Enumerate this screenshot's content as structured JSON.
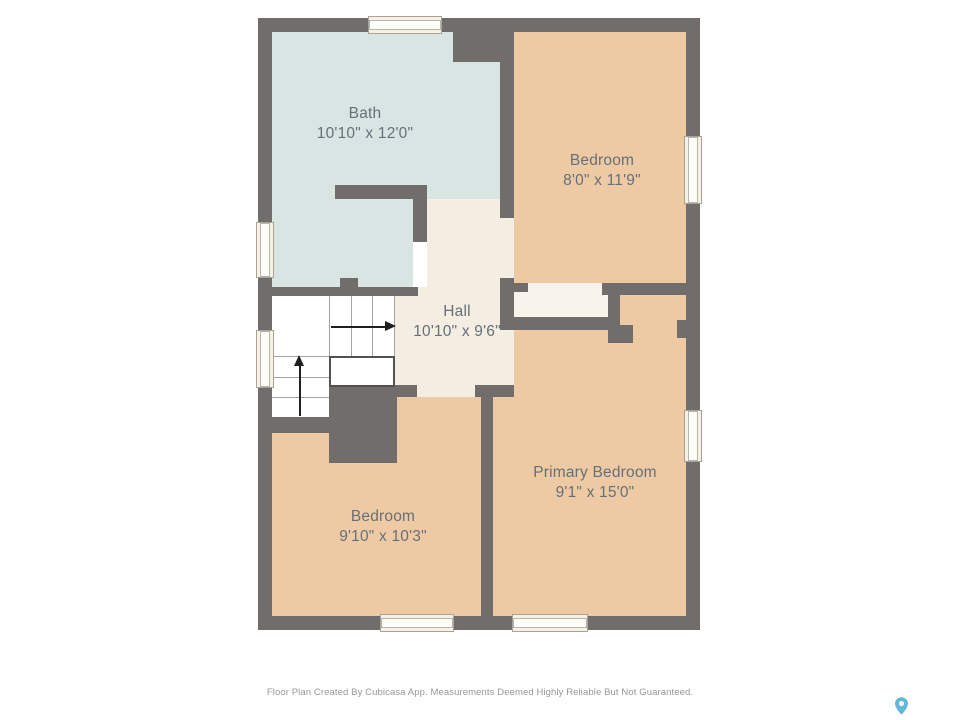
{
  "rooms": [
    {
      "name": "Bath",
      "dims": "10'10\" x 12'0\""
    },
    {
      "name": "Bedroom",
      "dims": "8'0\" x 11'9\""
    },
    {
      "name": "Hall",
      "dims": "10'10\" x 9'6\""
    },
    {
      "name": "Primary Bedroom",
      "dims": "9'1\" x 15'0\""
    },
    {
      "name": "Bedroom",
      "dims": "9'10\" x 10'3\""
    }
  ],
  "footer": {
    "disclaimer": "Floor Plan Created By Cubicasa App. Measurements Deemed Highly Reliable But Not Guaranteed."
  },
  "colors": {
    "wall": "#706d6b",
    "bath_floor": "#d9e5e3",
    "bedroom_floor": "#eecaa4",
    "hall_floor": "#f4ede2",
    "closet_floor": "#f8f3eb",
    "window_fill": "#f6f1e4",
    "label_text": "#657079",
    "pin": "#66b6d7"
  }
}
